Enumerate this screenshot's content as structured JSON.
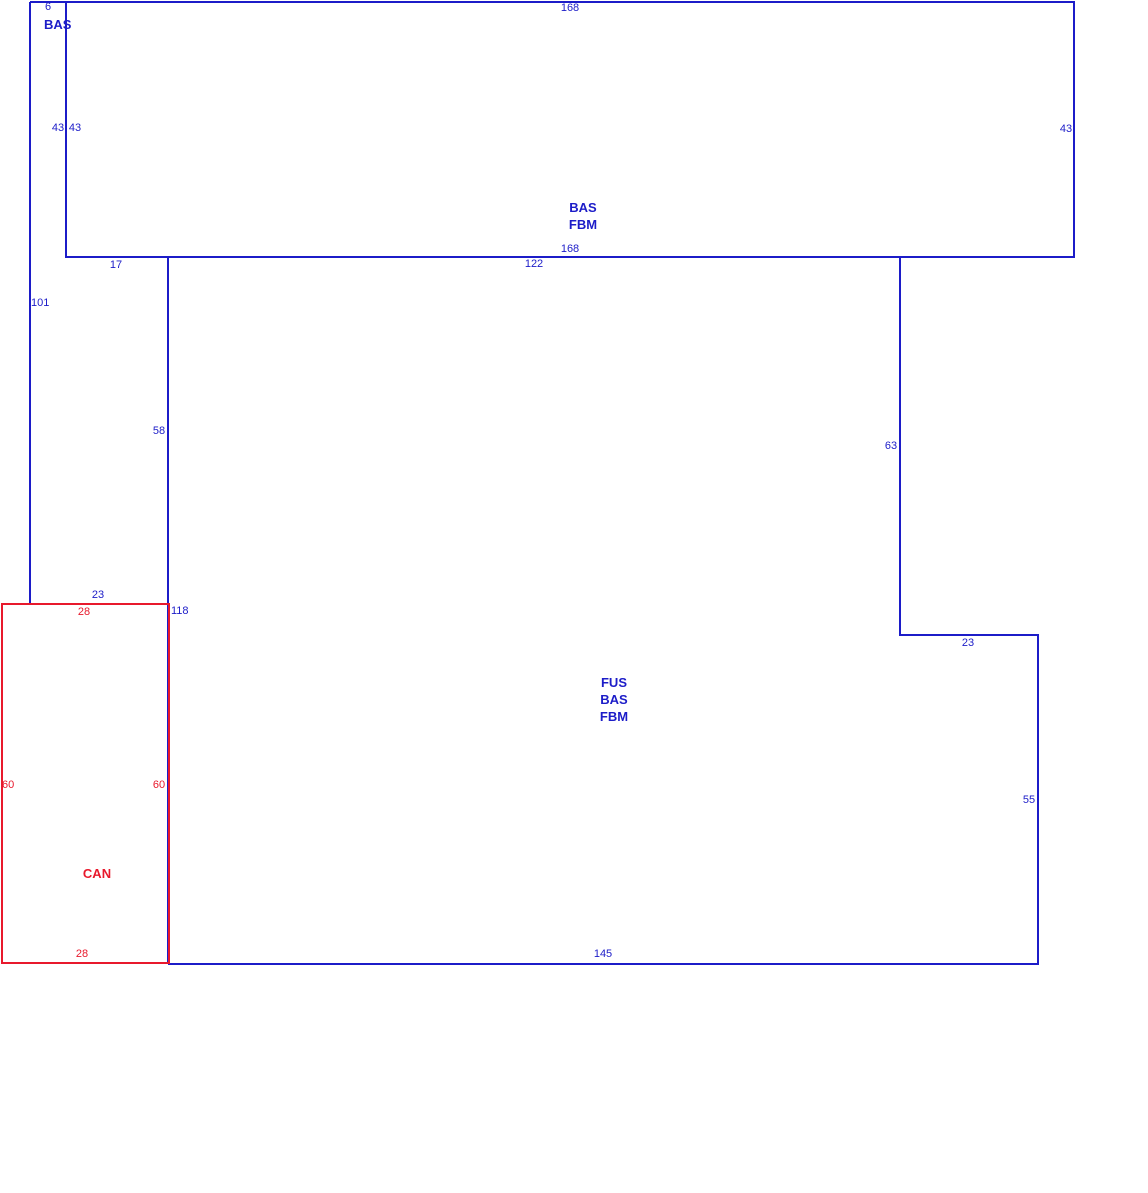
{
  "sketch": {
    "colors": {
      "line_blue": "#1c1cc8",
      "line_red": "#e8192c",
      "background": "#ffffff"
    },
    "areas": {
      "bas_upper": {
        "label": "BAS"
      },
      "bas_fbm": {
        "line1": "BAS",
        "line2": "FBM"
      },
      "fus_bas_fbm": {
        "line1": "FUS",
        "line2": "BAS",
        "line3": "FBM"
      },
      "can": {
        "label": "CAN"
      }
    },
    "dimensions": {
      "d6": "6",
      "d168_top": "168",
      "d43_strip": "43",
      "d43_left": "43",
      "d43_right": "43",
      "d168_bottom": "168",
      "d17": "17",
      "d122": "122",
      "d101": "101",
      "d58": "58",
      "d63": "63",
      "d23_step": "23",
      "d23_left": "23",
      "d28_top": "28",
      "d118": "118",
      "d60_left": "60",
      "d60_right": "60",
      "d55": "55",
      "d28_bottom": "28",
      "d145": "145"
    }
  }
}
